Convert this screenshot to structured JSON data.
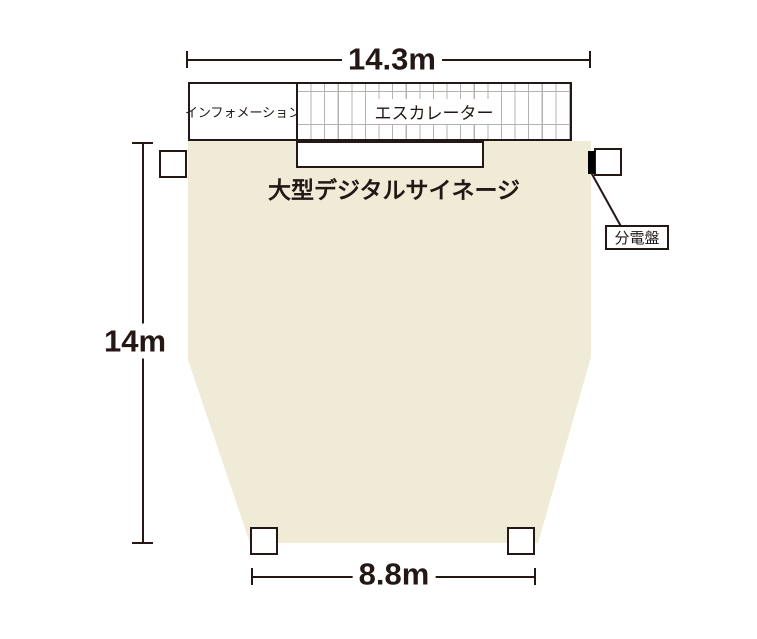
{
  "diagram": {
    "type": "floor-plan",
    "dimensions": {
      "top_width": "14.3m",
      "left_height": "14m",
      "bottom_width": "8.8m"
    },
    "areas": {
      "information_label": "インフォメーション",
      "escalator_label": "エスカレーター",
      "signage_label": "大型デジタルサイネージ",
      "distribution_board_label": "分電盤"
    },
    "colors": {
      "floor_fill": "#EFEBD7",
      "line_black": "#231815",
      "grid_gray": "#b3b3b3",
      "background": "#ffffff"
    }
  }
}
